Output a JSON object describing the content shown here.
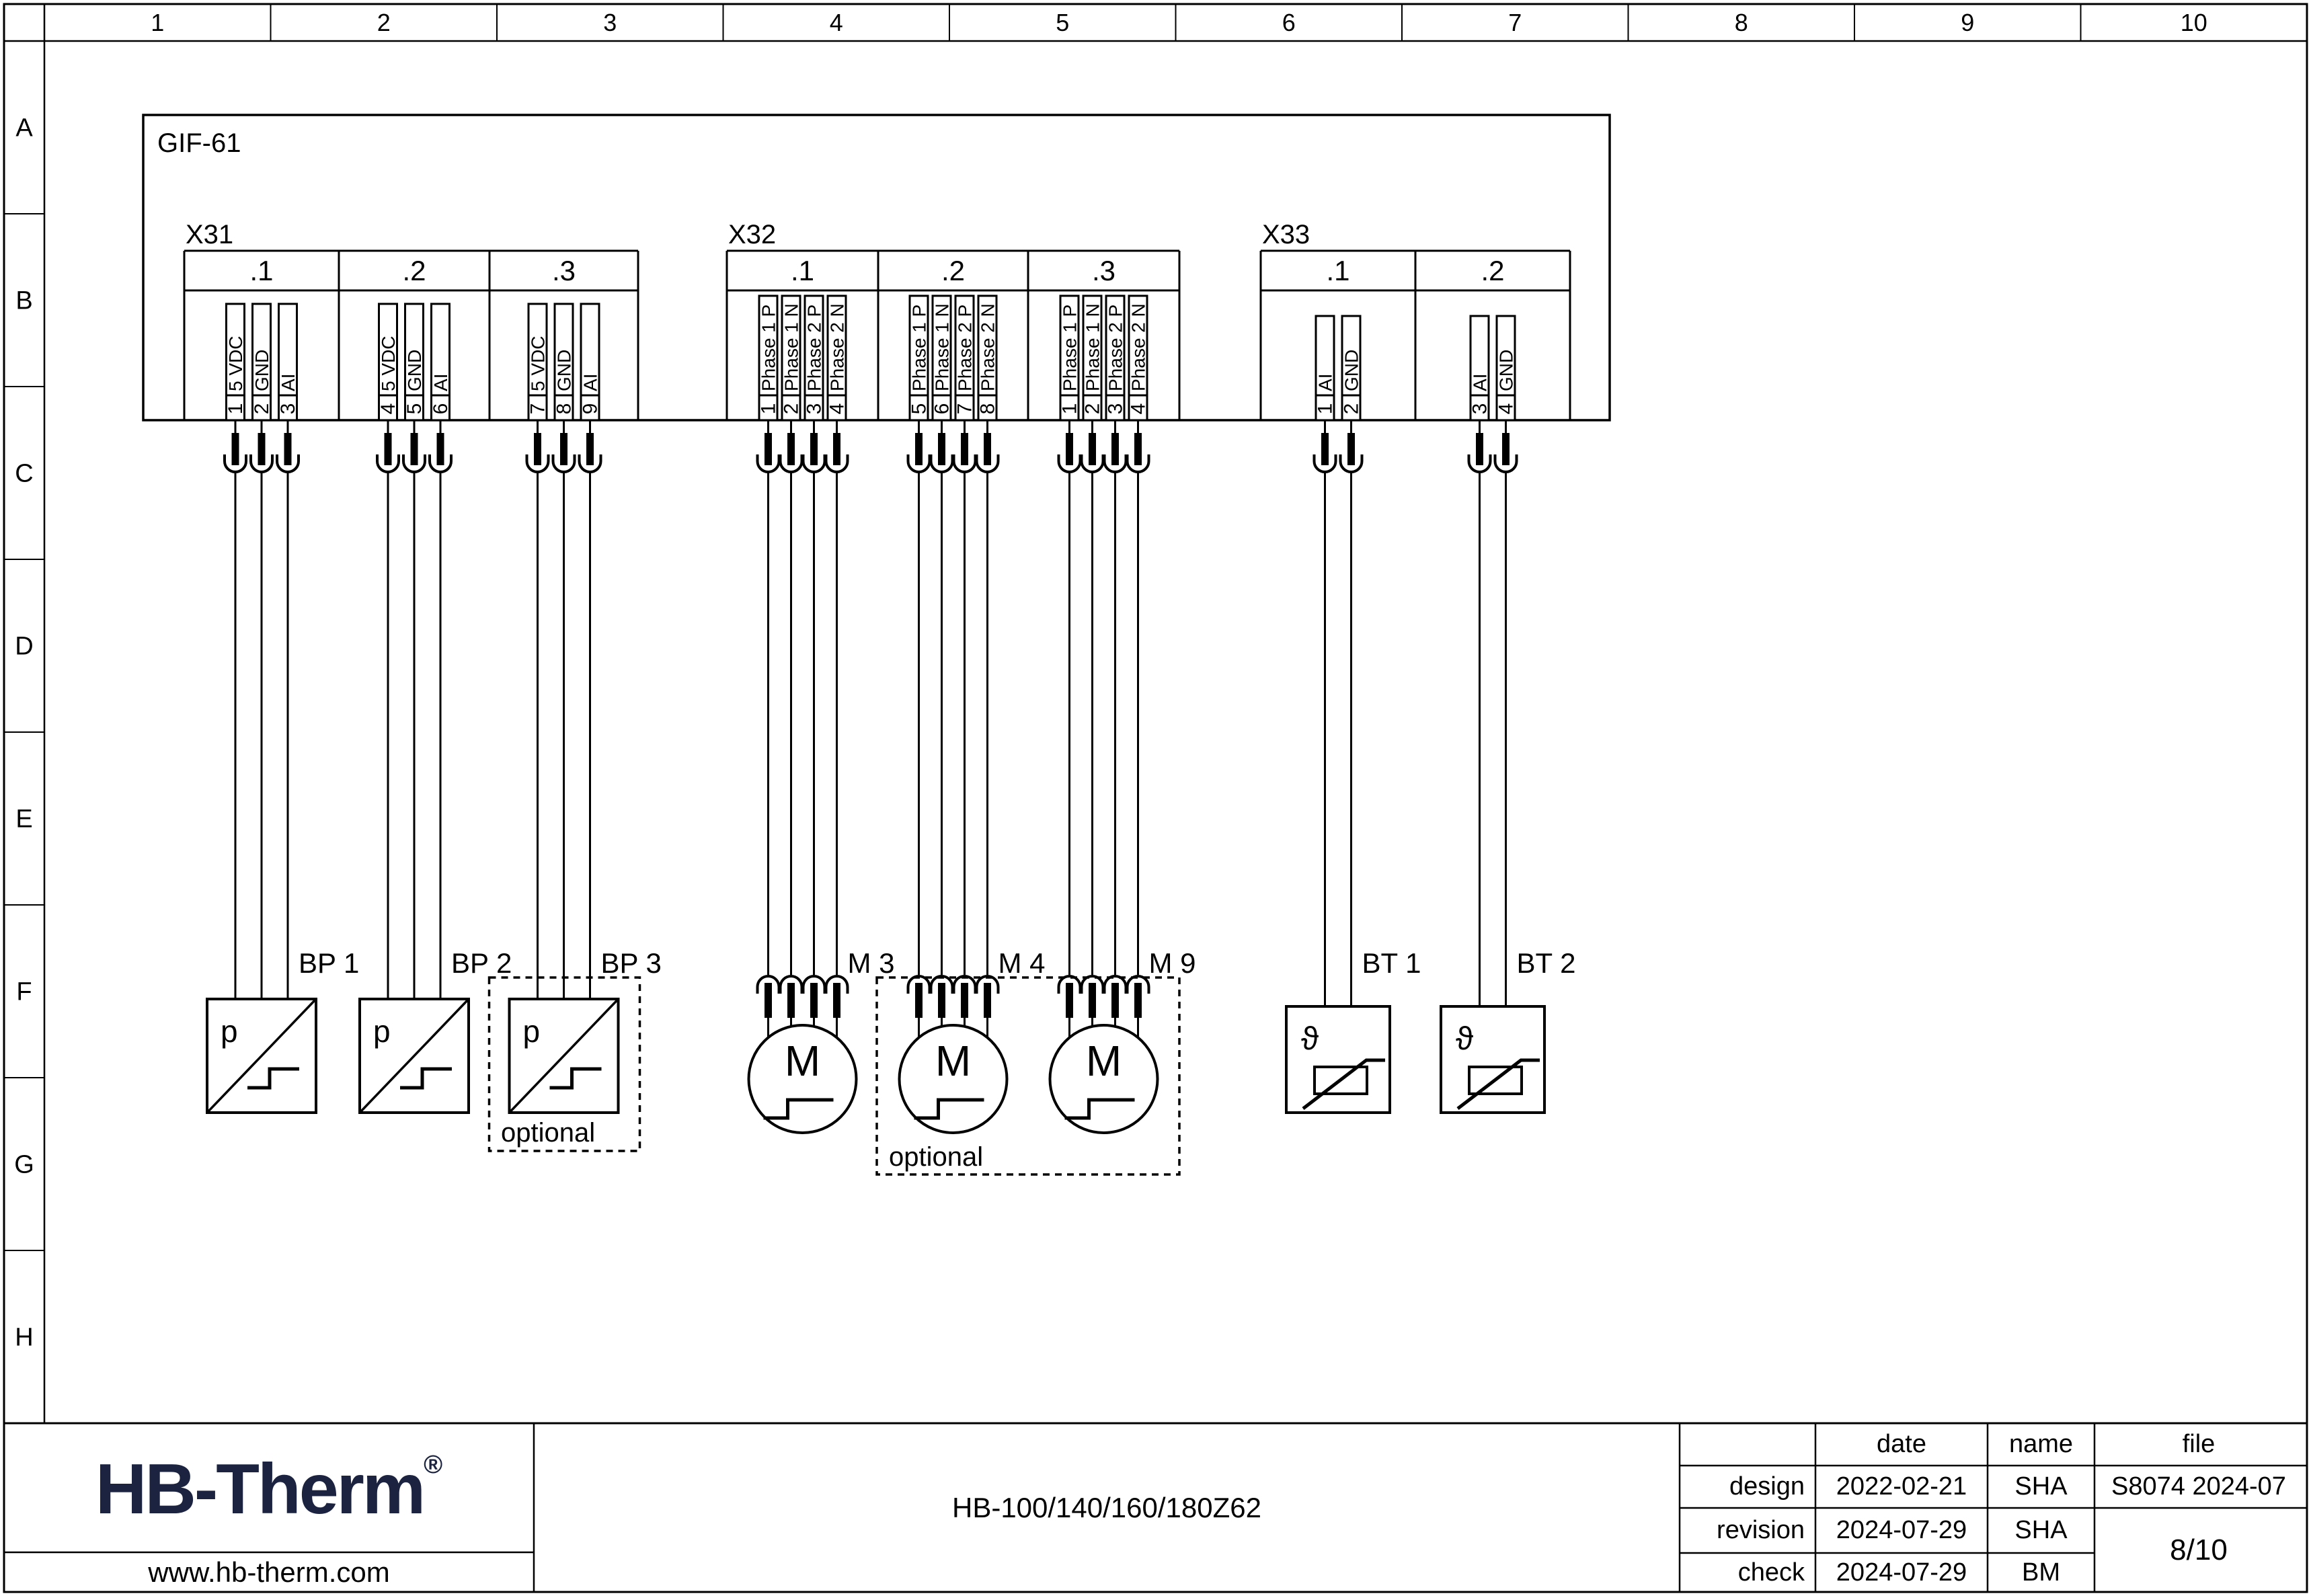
{
  "page_type": "electrical schematic sheet",
  "rulers": {
    "columns": [
      "1",
      "2",
      "3",
      "4",
      "5",
      "6",
      "7",
      "8",
      "9",
      "10"
    ],
    "rows": [
      "A",
      "B",
      "C",
      "D",
      "E",
      "F",
      "G",
      "H"
    ]
  },
  "main_box": {
    "label": "GIF-61"
  },
  "connectors": [
    {
      "id": "X31",
      "sections": [
        {
          "label": ".1",
          "pins": [
            {
              "n": "1",
              "t": "5 VDC"
            },
            {
              "n": "2",
              "t": "GND"
            },
            {
              "n": "3",
              "t": "AI"
            }
          ]
        },
        {
          "label": ".2",
          "pins": [
            {
              "n": "4",
              "t": "5 VDC"
            },
            {
              "n": "5",
              "t": "GND"
            },
            {
              "n": "6",
              "t": "AI"
            }
          ]
        },
        {
          "label": ".3",
          "pins": [
            {
              "n": "7",
              "t": "5 VDC"
            },
            {
              "n": "8",
              "t": "GND"
            },
            {
              "n": "9",
              "t": "AI"
            }
          ]
        }
      ]
    },
    {
      "id": "X32",
      "sections": [
        {
          "label": ".1",
          "pins": [
            {
              "n": "1",
              "t": "Phase 1 P"
            },
            {
              "n": "2",
              "t": "Phase 1 N"
            },
            {
              "n": "3",
              "t": "Phase 2 P"
            },
            {
              "n": "4",
              "t": "Phase 2 N"
            }
          ]
        },
        {
          "label": ".2",
          "pins": [
            {
              "n": "5",
              "t": "Phase 1 P"
            },
            {
              "n": "6",
              "t": "Phase 1 N"
            },
            {
              "n": "7",
              "t": "Phase 2 P"
            },
            {
              "n": "8",
              "t": "Phase 2 N"
            }
          ]
        },
        {
          "label": ".3",
          "pins": [
            {
              "n": "1",
              "t": "Phase 1 P"
            },
            {
              "n": "2",
              "t": "Phase 1 N"
            },
            {
              "n": "3",
              "t": "Phase 2 P"
            },
            {
              "n": "4",
              "t": "Phase 2 N"
            }
          ]
        }
      ]
    },
    {
      "id": "X33",
      "sections": [
        {
          "label": ".1",
          "pins": [
            {
              "n": "1",
              "t": "AI"
            },
            {
              "n": "2",
              "t": "GND"
            }
          ]
        },
        {
          "label": ".2",
          "pins": [
            {
              "n": "3",
              "t": "AI"
            },
            {
              "n": "4",
              "t": "GND"
            }
          ]
        }
      ]
    }
  ],
  "devices": [
    {
      "label": "BP 1",
      "symbol": "p"
    },
    {
      "label": "BP 2",
      "symbol": "p"
    },
    {
      "label": "BP 3",
      "symbol": "p"
    },
    {
      "label": "M 3",
      "symbol": "M"
    },
    {
      "label": "M 4",
      "symbol": "M"
    },
    {
      "label": "M 9",
      "symbol": "M"
    },
    {
      "label": "BT 1",
      "symbol": "ϑ"
    },
    {
      "label": "BT 2",
      "symbol": "ϑ"
    }
  ],
  "optional_boxes": [
    {
      "label": "optional"
    },
    {
      "label": "optional"
    }
  ],
  "brand": {
    "logo": "HB-Therm",
    "reg": "®",
    "website": "www.hb-therm.com",
    "logo_color": "#1b2340"
  },
  "doc_title": "HB-100/140/160/180Z62",
  "title_block": {
    "headers": {
      "date": "date",
      "name": "name",
      "file": "file"
    },
    "rows": [
      {
        "label": "design",
        "date": "2022-02-21",
        "name": "SHA"
      },
      {
        "label": "revision",
        "date": "2024-07-29",
        "name": "SHA"
      },
      {
        "label": "check",
        "date": "2024-07-29",
        "name": "BM"
      }
    ],
    "file_value": "S8074 2024-07",
    "page": "8/10"
  }
}
